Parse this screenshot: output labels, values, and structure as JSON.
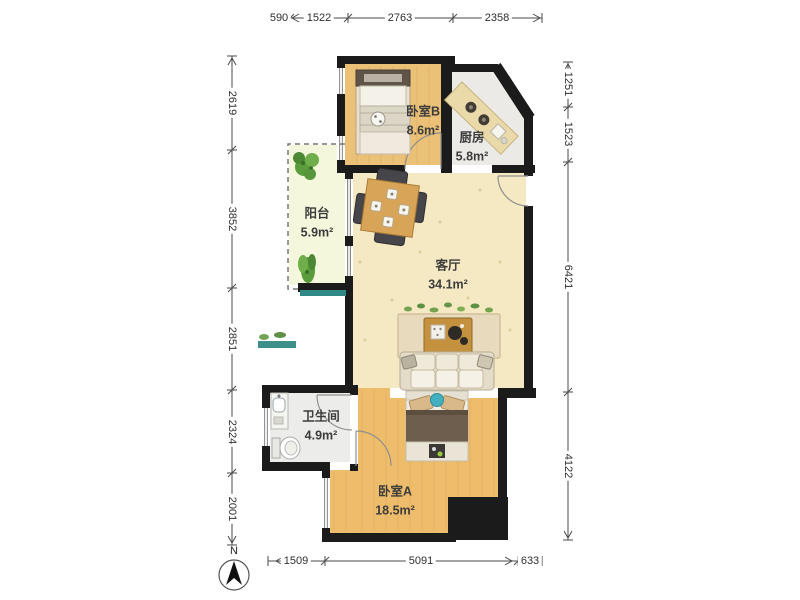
{
  "compass": {
    "label": "N"
  },
  "rooms": [
    {
      "id": "balcony",
      "name": "阳台",
      "area": "5.9m²"
    },
    {
      "id": "bedroom_b",
      "name": "卧室B",
      "area": "8.6m²"
    },
    {
      "id": "kitchen",
      "name": "厨房",
      "area": "5.8m²"
    },
    {
      "id": "living_room",
      "name": "客厅",
      "area": "34.1m²"
    },
    {
      "id": "bathroom",
      "name": "卫生间",
      "area": "4.9m²"
    },
    {
      "id": "bedroom_a",
      "name": "卧室A",
      "area": "18.5m²"
    }
  ],
  "dimensions_mm": {
    "top": [
      "590",
      "1522",
      "2763",
      "2358"
    ],
    "bottom": [
      "1509",
      "5091",
      "633"
    ],
    "left": [
      "2619",
      "3852",
      "2851",
      "2324",
      "2001"
    ],
    "right": [
      "1251",
      "1523",
      "6421",
      "4122"
    ]
  },
  "colors": {
    "wall": "#1b1b1b",
    "wood_floor_b": "#ebc178",
    "wood_floor_a": "#edbd6b",
    "living_floor": "#f5e9c3",
    "tile_floor": "#eceae6",
    "balcony_floor": "#f4f7dc",
    "accent_teal": "#43b0bf",
    "plant_green": "#5a9b3c",
    "dim_line": "#4a4a4a"
  }
}
